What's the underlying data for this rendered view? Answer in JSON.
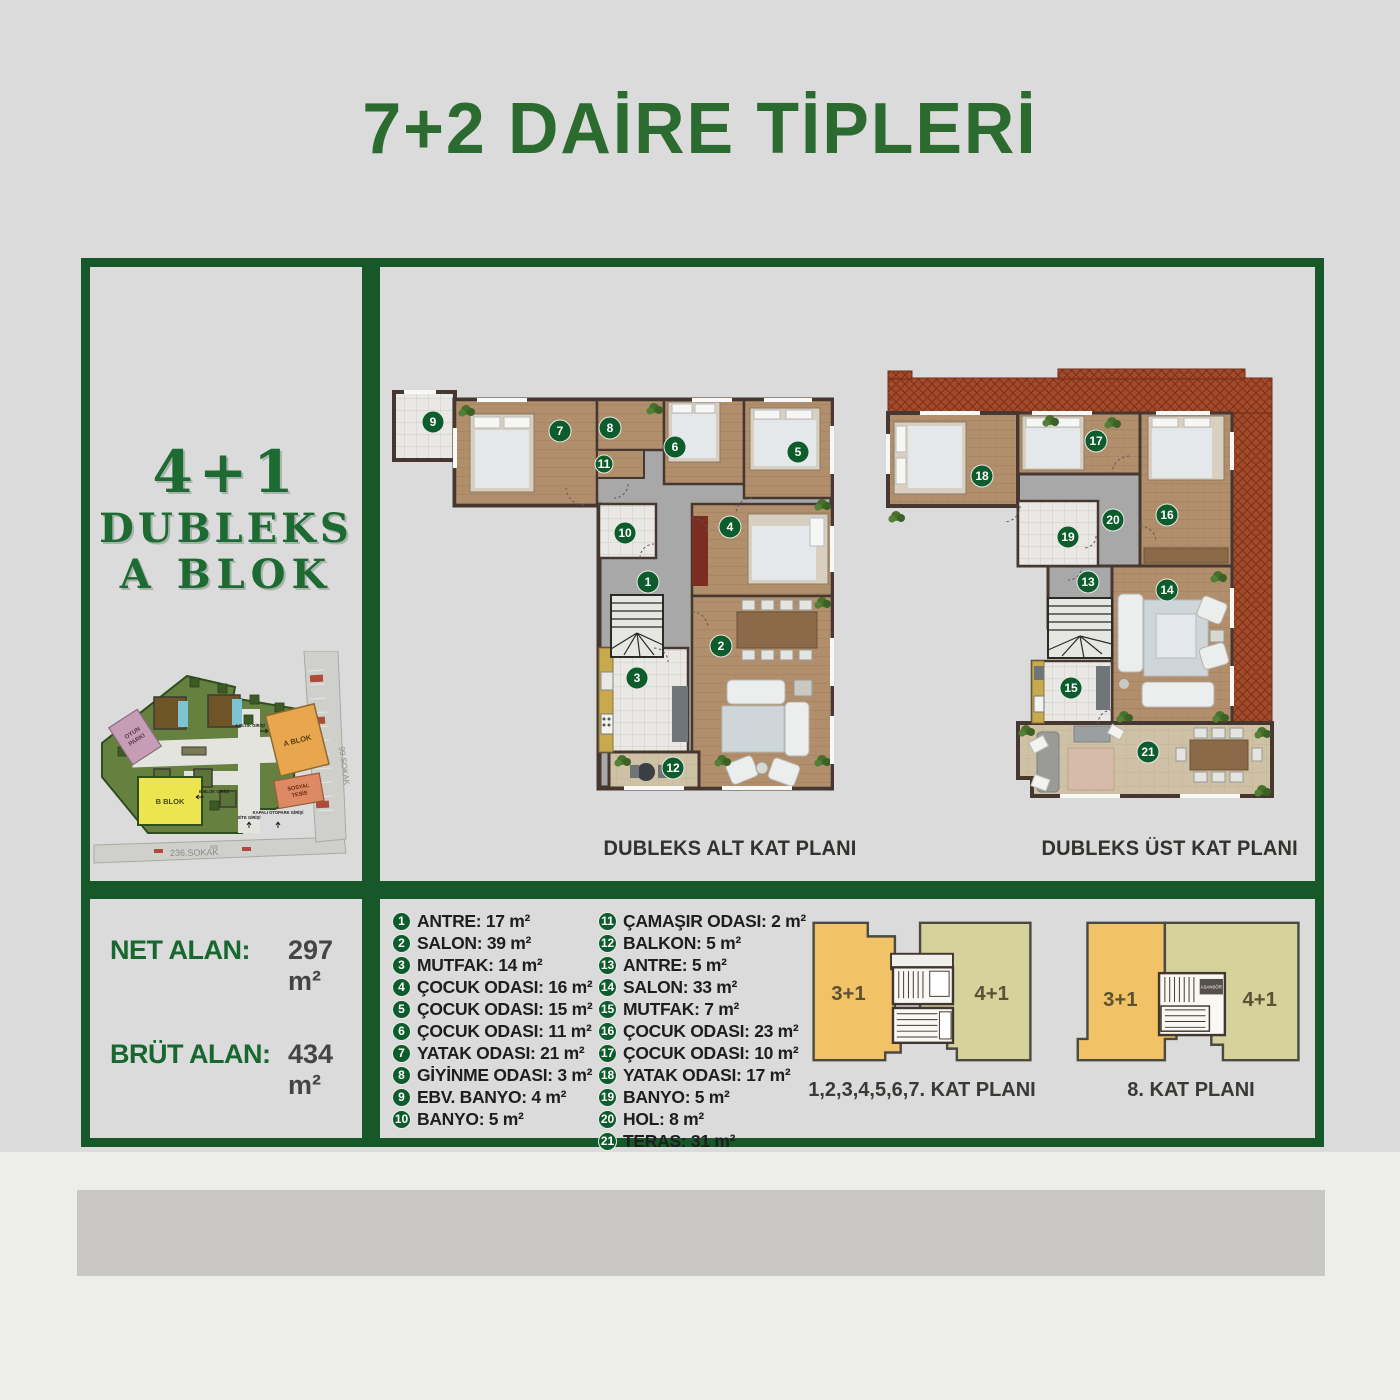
{
  "title": "7+2 DAİRE TİPLERİ",
  "sidebar": {
    "type": "4+1",
    "line2": "DUBLEKS",
    "line3": "A BLOK"
  },
  "areas": {
    "net_label": "NET ALAN:",
    "net_value": "297 m²",
    "brut_label": "BRÜT ALAN:",
    "brut_value": "434 m²"
  },
  "plans": {
    "alt_caption": "DUBLEKS ALT KAT PLANI",
    "ust_caption": "DUBLEKS ÜST KAT PLANI"
  },
  "site_plan": {
    "a_blok": "A BLOK",
    "b_blok": "B BLOK",
    "sosyal_1": "SOSYAL",
    "sosyal_2": "TESİS",
    "oyun_1": "OYUN",
    "oyun_2": "PARKI",
    "sokak_bottom": "236.SOKAK",
    "sokak_right": "99.SOKAK",
    "a_girisi": "A BLOK GİRİŞİ",
    "b_girisi": "B BLOK GİRİŞİ",
    "site_girisi": "SİTE GİRİŞİ",
    "otopark_girisi": "KAPALI OTOPARK GİRİŞİ"
  },
  "key_plans": {
    "plan1": {
      "left": "3+1",
      "right": "4+1",
      "caption": "1,2,3,4,5,6,7. KAT PLANI"
    },
    "plan2": {
      "left": "3+1",
      "right": "4+1",
      "asansor": "ASANSÖR",
      "caption": "8. KAT PLANI"
    }
  },
  "legend": {
    "col1": [
      {
        "num": "1",
        "label": "ANTRE: 17 m²"
      },
      {
        "num": "2",
        "label": "SALON: 39 m²"
      },
      {
        "num": "3",
        "label": "MUTFAK: 14 m²"
      },
      {
        "num": "4",
        "label": "ÇOCUK ODASI: 16 m²"
      },
      {
        "num": "5",
        "label": "ÇOCUK ODASI: 15 m²"
      },
      {
        "num": "6",
        "label": "ÇOCUK ODASI: 11 m²"
      },
      {
        "num": "7",
        "label": "YATAK ODASI: 21 m²"
      },
      {
        "num": "8",
        "label": "GİYİNME ODASI: 3 m²"
      },
      {
        "num": "9",
        "label": "EBV. BANYO: 4 m²"
      },
      {
        "num": "10",
        "label": "BANYO: 5 m²"
      }
    ],
    "col2": [
      {
        "num": "11",
        "label": "ÇAMAŞIR ODASI: 2 m²"
      },
      {
        "num": "12",
        "label": "BALKON: 5 m²"
      },
      {
        "num": "13",
        "label": "ANTRE: 5 m²"
      },
      {
        "num": "14",
        "label": "SALON: 33 m²"
      },
      {
        "num": "15",
        "label": "MUTFAK: 7 m²"
      },
      {
        "num": "16",
        "label": "ÇOCUK ODASI: 23 m²"
      },
      {
        "num": "17",
        "label": "ÇOCUK ODASI: 10 m²"
      },
      {
        "num": "18",
        "label": "YATAK ODASI: 17 m²"
      },
      {
        "num": "19",
        "label": "BANYO: 5 m²"
      },
      {
        "num": "20",
        "label": "HOL: 8 m²"
      },
      {
        "num": "21",
        "label": "TERAS: 31 m²"
      }
    ]
  },
  "colors": {
    "accent_green": "#17582b",
    "title_green": "#2c6b2f",
    "badge_green": "#0d5c2c",
    "wood": "#b28f6c",
    "hall_gray": "#a8a8a8",
    "roof_red": "#a3492c",
    "plan1_left": "#f2c366",
    "plan1_right": "#d5d29c"
  }
}
